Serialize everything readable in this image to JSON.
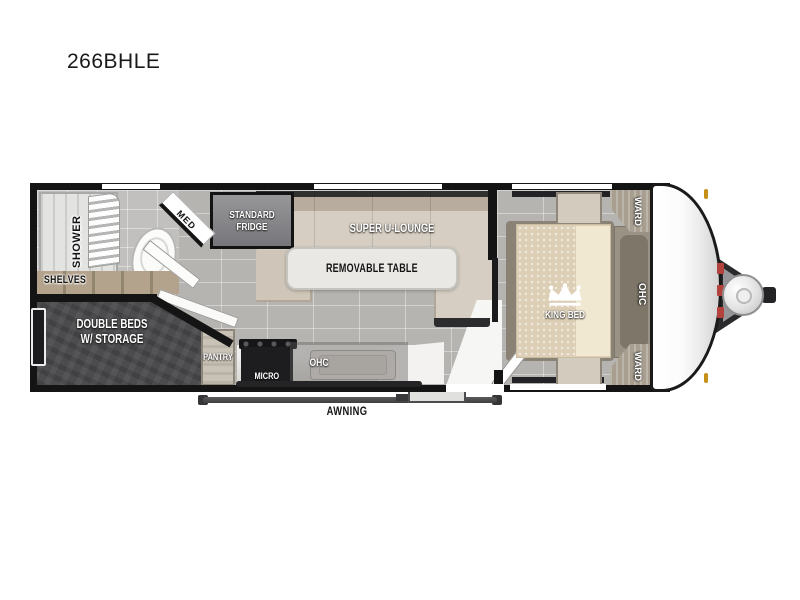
{
  "title": "266BHLE",
  "floorplan": {
    "bathroom": {
      "shower_label": "SHOWER",
      "shelves_label": "SHELVES",
      "med_label": "MED"
    },
    "kitchen": {
      "fridge_label": "STANDARD FRIDGE",
      "pantry_label": "PANTRY",
      "micro_label": "MICRO",
      "ohc_label": "OHC"
    },
    "living": {
      "lounge_label": "SUPER U-LOUNGE",
      "table_label": "REMOVABLE TABLE"
    },
    "bunk_room": {
      "label_line1": "DOUBLE BEDS",
      "label_line2": "W/ STORAGE"
    },
    "bedroom": {
      "bed_label": "KING BED",
      "ohc_label": "OHC",
      "ward_top_label": "WARD",
      "ward_bottom_label": "WARD"
    },
    "exterior": {
      "awning_label": "AWNING"
    }
  },
  "colors": {
    "wall_black": "#141414",
    "floor_tile": "#b6b4b1",
    "bunk_dark_gray": "#4c4c4e",
    "sofa_beige": "#d6cec2",
    "mattress_beige": "#dccfb5",
    "cabinet_taupe": "#9a9284",
    "fridge_gray": "#87878a",
    "awning_gray": "#49494b",
    "clearance_light_amber": "#c59018",
    "hitch_red": "#b2423b"
  }
}
